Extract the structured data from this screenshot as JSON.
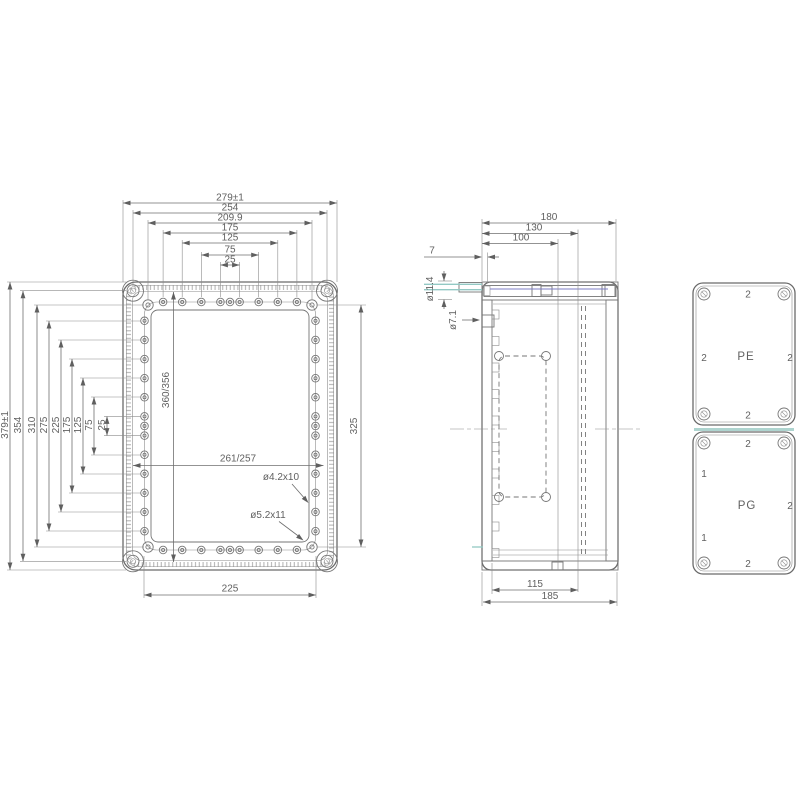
{
  "drawing": {
    "front_view": {
      "dims_top": [
        "279±1",
        "254",
        "209.9",
        "175",
        "125",
        "75",
        "25"
      ],
      "dims_left": [
        "379±1",
        "354",
        "310",
        "275",
        "225",
        "175",
        "125",
        "75",
        "25"
      ],
      "dim_inner_length": "360/356",
      "dim_screw_span_right": "325",
      "dim_inner_width": "261/257",
      "note_pilot_hole": "ø4.2x10",
      "note_corner_hole": "ø5.2x11",
      "dim_bottom_span": "225"
    },
    "side_view": {
      "dims_top": [
        "180",
        "130",
        "100"
      ],
      "dim_lid_lip": "7",
      "dim_gland_dia": "ø11.4",
      "dim_boss_dia": "ø7.1",
      "dims_bottom": [
        "115",
        "185"
      ]
    },
    "gland_plates": {
      "pe_plate": {
        "label": "PE",
        "count_top": "2",
        "count_left": "2",
        "count_right": "2",
        "count_bottom": "2"
      },
      "pg_plate": {
        "label": "PG",
        "count_top": "2",
        "count_left_upper": "1",
        "count_left_lower": "1",
        "count_right": "2",
        "count_bottom": "2"
      }
    }
  }
}
